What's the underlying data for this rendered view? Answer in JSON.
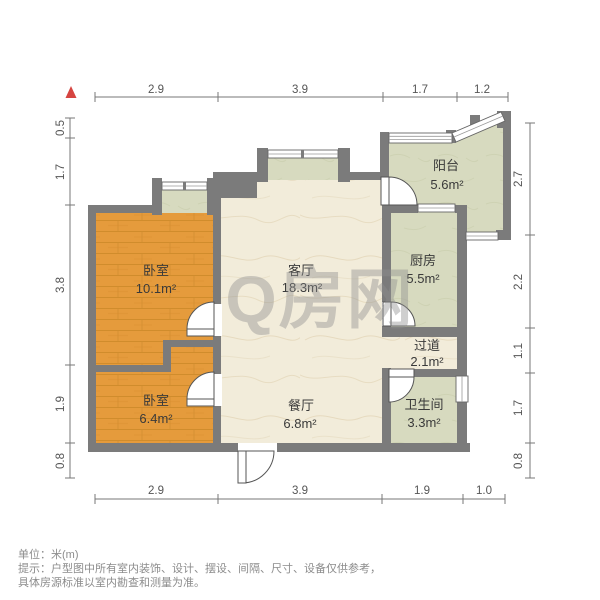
{
  "watermark": {
    "text": "Q房网"
  },
  "rooms": [
    {
      "id": "bedroom-1",
      "name": "卧室",
      "area": "10.1m²"
    },
    {
      "id": "bedroom-2",
      "name": "卧室",
      "area": "6.4m²"
    },
    {
      "id": "living-room",
      "name": "客厅",
      "area": "18.3m²"
    },
    {
      "id": "dining-room",
      "name": "餐厅",
      "area": "6.8m²"
    },
    {
      "id": "balcony",
      "name": "阳台",
      "area": "5.6m²"
    },
    {
      "id": "kitchen",
      "name": "厨房",
      "area": "5.5m²"
    },
    {
      "id": "hallway",
      "name": "过道",
      "area": "2.1m²"
    },
    {
      "id": "bathroom",
      "name": "卫生间",
      "area": "3.3m²"
    }
  ],
  "dimensions": {
    "top": [
      "2.9",
      "3.9",
      "1.7",
      "1.2"
    ],
    "bottom": [
      "2.9",
      "3.9",
      "1.9",
      "1.0"
    ],
    "left": [
      "0.5",
      "1.7",
      "3.8",
      "1.9",
      "0.8"
    ],
    "right": [
      "2.7",
      "2.2",
      "1.1",
      "1.7",
      "0.8"
    ]
  },
  "footer": {
    "unit": "单位：米(m)",
    "note1": "提示：户型图中所有室内装饰、设计、摆设、间隔、尺寸、设备仅供参考，",
    "note2": "具体房源标准以室内勘查和测量为准。"
  },
  "colors": {
    "wall": "#7b7b7b",
    "wood_floor": "#e59b3c",
    "marble_floor": "#f2ecda",
    "sage_floor": "#d7dabf",
    "north_arrow": "#d64541",
    "watermark": "#8f8f8f",
    "dimension_text": "#555555",
    "footer_text": "#8c8c8c"
  }
}
